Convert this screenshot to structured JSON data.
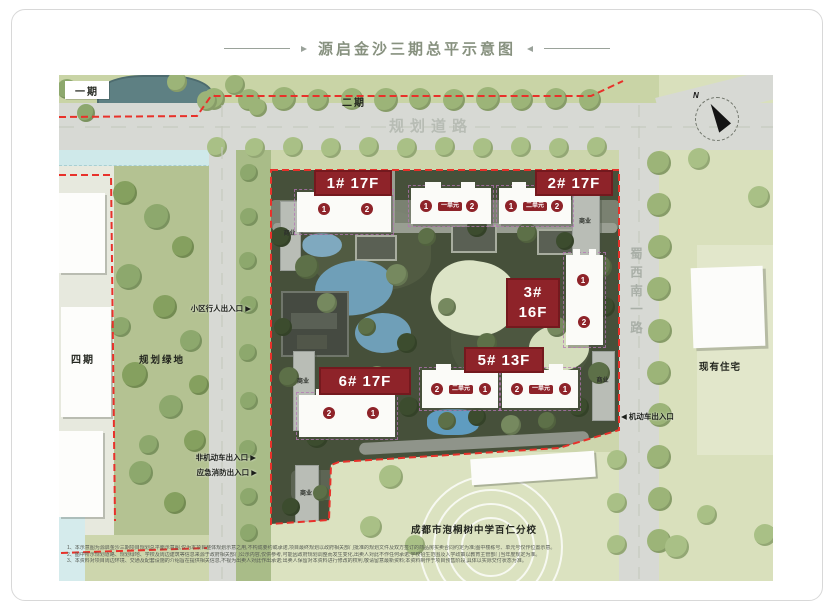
{
  "title": {
    "text": "源启金沙三期总平示意图"
  },
  "compass": {
    "label": "N"
  },
  "phases": {
    "phase1": "一期",
    "phase2": "二期",
    "phase4": "四期"
  },
  "areas": {
    "planned_road": "规划道路",
    "planned_green": "规划绿地",
    "existing_residence": "现有住宅",
    "west_road": "蜀西南一路",
    "school": "成都市泡桐树中学百仁分校",
    "commercial": "商业"
  },
  "buildings": {
    "b1": {
      "label": "1# 17F",
      "unit_left": "1",
      "unit_right": "2"
    },
    "b2": {
      "label": "2# 17F",
      "wing1": {
        "left": "1",
        "name": "一单元",
        "right": "2"
      },
      "wing2": {
        "left": "1",
        "name": "二单元",
        "right": "2"
      }
    },
    "b3": {
      "label_top": "3#",
      "label_bottom": "16F",
      "unit_upper": "1",
      "unit_lower": "2"
    },
    "b5": {
      "label": "5# 13F",
      "wing1": {
        "left": "2",
        "name": "二单元",
        "right": "1"
      },
      "wing2": {
        "left": "2",
        "name": "一单元",
        "right": "1"
      }
    },
    "b6": {
      "label": "6# 17F",
      "unit_left": "2",
      "unit_right": "1"
    }
  },
  "entrances": {
    "pedestrian": "小区行人出入口",
    "non_motor": "非机动车出入口",
    "emergency_fire": "应急消防出入口",
    "motor": "机动车出入口",
    "arrow_right": "▶",
    "arrow_left": "◀"
  },
  "fine_print": {
    "line1": "1、本示意图为源启金沙三期项目规划总平面示意图,仅为本项目整体规划示意之用,不构成要约或承诺,项目最终规划以政府相关部门批准的规划文件及双方签订的商品房买卖合同约定为准;图中楼栋号、单元号仅作位置示意。",
    "line2": "2、图中所示规划道路、规划绿地、学校及周边建筑等信息来源于政府相关部门公示内容,仅供参考,可能因政府规划调整而发生变化,出卖人对此不作任何承诺;学校招生范围及入学政策以教育主管部门当年度规定为准。",
    "line3": "3、本资料对项目周边环境、交通及配套设施的介绍旨在提供相关信息,不视为出卖人对此作出承诺;出卖人保留对本资料进行修改的权利,敬请留意最新资料;本资料制作于项目预售阶段,具体以实际交付状态为准。"
  },
  "colors": {
    "boundary_red": "#e8312a",
    "building_label_red": "#8e2329",
    "site_green": "#46503a",
    "road_gray": "#d7d9d4",
    "water_blue": "#cfe9ea",
    "map_green": "#cdd6ad"
  },
  "decor": {
    "tree_colors": [
      "#9cb478",
      "#a9c086",
      "#8da86d",
      "#85a05f",
      "#5d7048",
      "#3c4c2e",
      "#76895f"
    ],
    "trees_outer": [
      [
        155,
        24,
        11,
        0
      ],
      [
        190,
        25,
        11,
        0
      ],
      [
        225,
        24,
        12,
        0
      ],
      [
        259,
        25,
        11,
        0
      ],
      [
        293,
        24,
        11,
        0
      ],
      [
        327,
        25,
        12,
        0
      ],
      [
        361,
        24,
        11,
        0
      ],
      [
        395,
        25,
        11,
        0
      ],
      [
        429,
        24,
        12,
        0
      ],
      [
        463,
        25,
        11,
        0
      ],
      [
        497,
        24,
        11,
        0
      ],
      [
        531,
        25,
        11,
        0
      ],
      [
        8,
        14,
        10,
        2
      ],
      [
        27,
        38,
        9,
        2
      ],
      [
        118,
        7,
        10,
        0
      ],
      [
        148,
        26,
        10,
        0
      ],
      [
        176,
        10,
        10,
        0
      ],
      [
        199,
        33,
        9,
        0
      ],
      [
        158,
        72,
        10,
        1
      ],
      [
        196,
        73,
        10,
        1
      ],
      [
        234,
        72,
        10,
        1
      ],
      [
        272,
        73,
        10,
        1
      ],
      [
        310,
        72,
        10,
        1
      ],
      [
        348,
        73,
        10,
        1
      ],
      [
        386,
        72,
        10,
        1
      ],
      [
        424,
        73,
        10,
        1
      ],
      [
        462,
        72,
        10,
        1
      ],
      [
        500,
        73,
        10,
        1
      ],
      [
        538,
        72,
        10,
        1
      ],
      [
        600,
        88,
        12,
        0
      ],
      [
        600,
        130,
        12,
        0
      ],
      [
        601,
        172,
        12,
        0
      ],
      [
        600,
        214,
        12,
        0
      ],
      [
        601,
        256,
        12,
        0
      ],
      [
        600,
        298,
        12,
        0
      ],
      [
        601,
        340,
        12,
        0
      ],
      [
        600,
        382,
        12,
        0
      ],
      [
        601,
        424,
        12,
        0
      ],
      [
        600,
        466,
        12,
        0
      ],
      [
        558,
        385,
        10,
        1
      ],
      [
        558,
        428,
        10,
        1
      ],
      [
        558,
        470,
        10,
        1
      ],
      [
        190,
        98,
        9,
        2
      ],
      [
        190,
        142,
        9,
        2
      ],
      [
        189,
        186,
        9,
        2
      ],
      [
        190,
        230,
        9,
        2
      ],
      [
        189,
        278,
        9,
        2
      ],
      [
        190,
        326,
        9,
        2
      ],
      [
        189,
        374,
        9,
        2
      ],
      [
        190,
        422,
        9,
        2
      ],
      [
        190,
        458,
        9,
        2
      ],
      [
        66,
        118,
        12,
        3
      ],
      [
        98,
        142,
        13,
        2
      ],
      [
        124,
        172,
        11,
        3
      ],
      [
        70,
        202,
        13,
        2
      ],
      [
        106,
        232,
        12,
        3
      ],
      [
        132,
        266,
        11,
        2
      ],
      [
        76,
        300,
        13,
        3
      ],
      [
        112,
        332,
        12,
        2
      ],
      [
        136,
        366,
        11,
        3
      ],
      [
        82,
        398,
        12,
        2
      ],
      [
        116,
        428,
        11,
        3
      ],
      [
        62,
        252,
        10,
        2
      ],
      [
        140,
        310,
        10,
        3
      ],
      [
        90,
        370,
        10,
        2
      ],
      [
        332,
        402,
        12,
        1
      ],
      [
        312,
        452,
        11,
        1
      ],
      [
        356,
        470,
        10,
        1
      ],
      [
        618,
        472,
        12,
        1
      ],
      [
        648,
        440,
        10,
        1
      ],
      [
        640,
        84,
        11,
        1
      ],
      [
        700,
        122,
        11,
        1
      ],
      [
        706,
        460,
        11,
        1
      ]
    ],
    "trees_site": [
      [
        10,
        67,
        10,
        5
      ],
      [
        36,
        97,
        12,
        4
      ],
      [
        86,
        53,
        9,
        5
      ],
      [
        126,
        105,
        11,
        6
      ],
      [
        156,
        67,
        9,
        4
      ],
      [
        206,
        57,
        10,
        5
      ],
      [
        256,
        63,
        10,
        4
      ],
      [
        294,
        71,
        9,
        5
      ],
      [
        330,
        97,
        11,
        4
      ],
      [
        334,
        137,
        10,
        5
      ],
      [
        328,
        203,
        11,
        4
      ],
      [
        308,
        237,
        10,
        5
      ],
      [
        276,
        251,
        9,
        4
      ],
      [
        240,
        255,
        10,
        6
      ],
      [
        206,
        247,
        9,
        5
      ],
      [
        176,
        251,
        9,
        4
      ],
      [
        138,
        237,
        10,
        5
      ],
      [
        106,
        207,
        11,
        6
      ],
      [
        76,
        237,
        10,
        4
      ],
      [
        46,
        267,
        11,
        5
      ],
      [
        18,
        207,
        10,
        4
      ],
      [
        12,
        157,
        9,
        5
      ],
      [
        56,
        133,
        10,
        6
      ],
      [
        96,
        157,
        9,
        4
      ],
      [
        136,
        173,
        10,
        5
      ],
      [
        176,
        137,
        9,
        6
      ],
      [
        216,
        173,
        10,
        4
      ],
      [
        256,
        203,
        9,
        5
      ],
      [
        286,
        157,
        10,
        6
      ],
      [
        246,
        117,
        9,
        4
      ],
      [
        20,
        337,
        9,
        5
      ],
      [
        50,
        323,
        8,
        4
      ],
      [
        88,
        335,
        9,
        6
      ],
      [
        118,
        347,
        8,
        5
      ],
      [
        158,
        343,
        9,
        4
      ]
    ]
  }
}
